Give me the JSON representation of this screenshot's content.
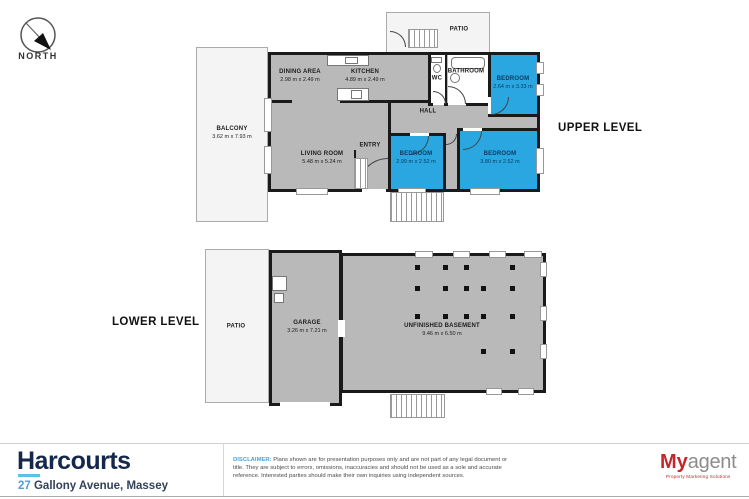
{
  "compass": {
    "label": "NORTH"
  },
  "upper": {
    "level_label": "UPPER LEVEL",
    "rooms": [
      {
        "name": "BALCONY",
        "dims": "3.62 m x 7.93 m"
      },
      {
        "name": "DINING AREA",
        "dims": "2.98 m x 2.49 m"
      },
      {
        "name": "KITCHEN",
        "dims": "4.89 m x 2.49 m"
      },
      {
        "name": "WC",
        "dims": ""
      },
      {
        "name": "BATHROOM",
        "dims": ""
      },
      {
        "name": "HALL",
        "dims": ""
      },
      {
        "name": "ENTRY",
        "dims": ""
      },
      {
        "name": "LIVING ROOM",
        "dims": "5.48 m x 5.24 m"
      },
      {
        "name": "BEDROOM",
        "dims": "2.64 m x 3.33 m"
      },
      {
        "name": "BEDROOM",
        "dims": "2.99 m x 2.52 m"
      },
      {
        "name": "BEDROOM",
        "dims": "3.80 m x 2.52 m"
      },
      {
        "name": "PATIO",
        "dims": ""
      }
    ]
  },
  "lower": {
    "level_label": "LOWER LEVEL",
    "rooms": [
      {
        "name": "PATIO",
        "dims": ""
      },
      {
        "name": "GARAGE",
        "dims": "3.26 m x 7.21 m"
      },
      {
        "name": "UNFINISHED BASEMENT",
        "dims": "9.46 m x 6.50 m"
      }
    ],
    "basement_posts": [
      [
        415,
        265
      ],
      [
        443,
        265
      ],
      [
        464,
        265
      ],
      [
        510,
        265
      ],
      [
        415,
        286
      ],
      [
        443,
        286
      ],
      [
        464,
        286
      ],
      [
        481,
        286
      ],
      [
        510,
        286
      ],
      [
        415,
        314
      ],
      [
        443,
        314
      ],
      [
        464,
        314
      ],
      [
        481,
        314
      ],
      [
        510,
        314
      ],
      [
        481,
        349
      ],
      [
        510,
        349
      ]
    ]
  },
  "footer": {
    "brand": "Harcourts",
    "address_number": "27",
    "address_rest": " Gallony Avenue, Massey",
    "disclaimer_label": "DISCLAIMER:",
    "disclaimer_text": " Plans shown are for presentation purposes only and are not part of any legal document or title. They are subject to errors, omissions, inaccuracies and should not be used as a sole and accurate reference. Interested parties should make their own inquiries using independent sources.",
    "agency_primary": "My",
    "agency_secondary": "agent",
    "agency_tagline": "Property Marketing Solutions"
  },
  "colors": {
    "room_highlight": "#2AA7E1",
    "floor_grey": "#B9B9B9",
    "wall_black": "#1A1A1A",
    "outdoor_light": "#F4F4F4",
    "brand_navy": "#15284B",
    "brand_cyan": "#5BC2E7",
    "address_blue": "#4E9FD4",
    "disclaimer_blue": "#49A5DE",
    "agency_red": "#C6252B",
    "agency_grey": "#8C8C8C"
  }
}
